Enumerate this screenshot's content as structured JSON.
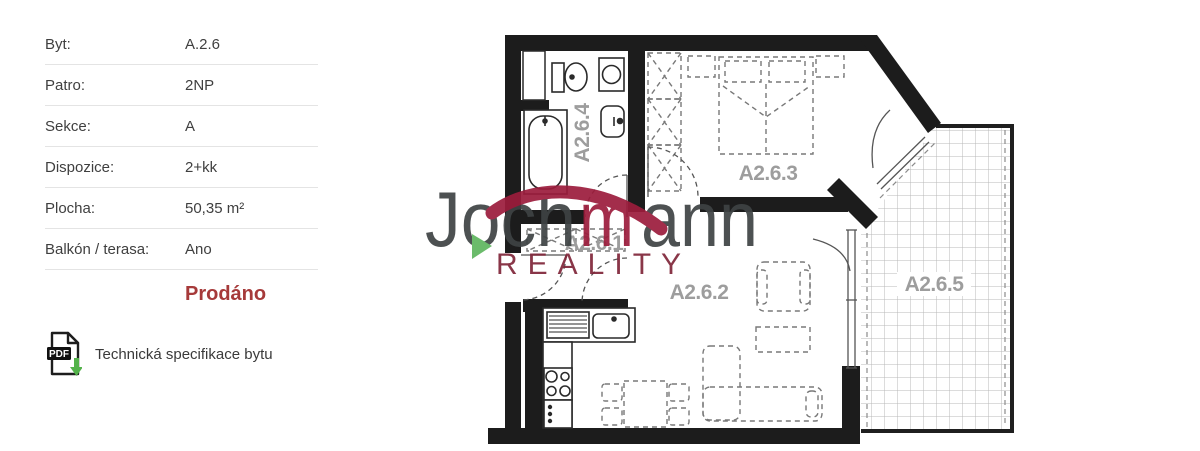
{
  "info_panel": {
    "rows": [
      {
        "label": "Byt:",
        "value": "A.2.6"
      },
      {
        "label": "Patro:",
        "value": "2NP"
      },
      {
        "label": "Sekce:",
        "value": "A"
      },
      {
        "label": "Dispozice:",
        "value": "2+kk"
      },
      {
        "label": "Plocha:",
        "value": "50,35 m²"
      },
      {
        "label": "Balkón / terasa:",
        "value": "Ano"
      }
    ],
    "status_label": "Prodáno",
    "pdf_icon_text": "PDF",
    "pdf_link_label": "Technická specifikace bytu"
  },
  "floorplan": {
    "room_labels": {
      "hall": "A2.6.1",
      "living": "A2.6.2",
      "bedroom": "A2.6.3",
      "bathroom": "A2.6.4",
      "terrace": "A2.6.5"
    },
    "watermark": {
      "brand_left": "Joch",
      "brand_mid": "m",
      "brand_right": "ann",
      "brand_sub": "REALITY"
    }
  },
  "colors": {
    "status_red": "#a63a3a",
    "wall_black": "#1c1c1c",
    "room_label_gray": "#9d9d9d",
    "brand_gray": "#3e4344",
    "brand_red": "#9c1c3c",
    "brand_sub_red": "#802639",
    "brand_green": "#5fb65f",
    "pdf_arrow_green": "#53b24a",
    "divider_gray": "#e4e4e4"
  }
}
